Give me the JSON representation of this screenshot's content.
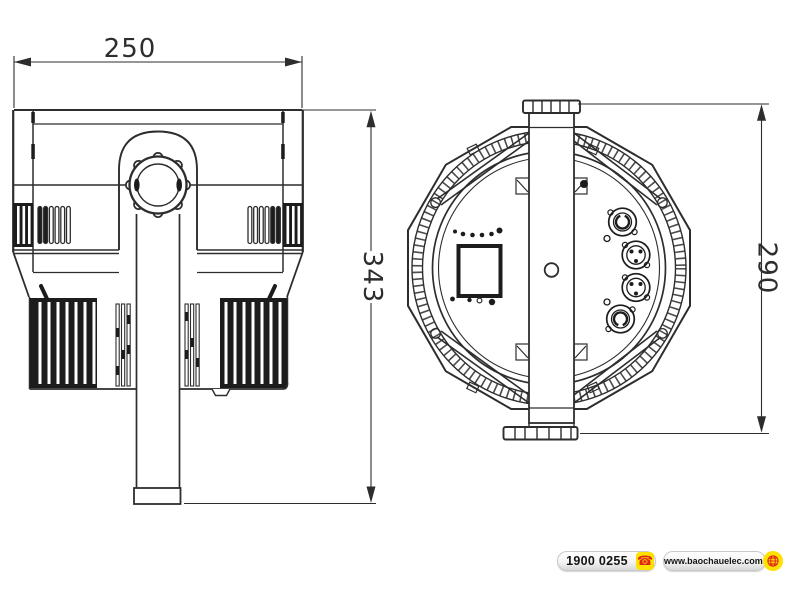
{
  "window": {
    "width": 800,
    "height": 600,
    "background": "#ffffff"
  },
  "drawing": {
    "subject": "LED PAR stage light dimensional drawing, side and rear orthographic views",
    "line_color": "#2d2d2d",
    "views": [
      {
        "name": "side-view",
        "dimensions": [
          {
            "label": "250",
            "orientation": "horizontal",
            "position": "top"
          },
          {
            "label": "343",
            "orientation": "vertical",
            "position": "right"
          }
        ]
      },
      {
        "name": "rear-view",
        "dimensions": [
          {
            "label": "290",
            "orientation": "vertical",
            "position": "right"
          }
        ]
      }
    ]
  },
  "footer": {
    "hotline": {
      "label": "1900 0255",
      "icon": "phone-icon"
    },
    "website": {
      "label": "www.baochauelec.com",
      "icon": "globe-icon"
    },
    "accent_yellow": "#ffe100",
    "icon_red": "#e0251b"
  }
}
